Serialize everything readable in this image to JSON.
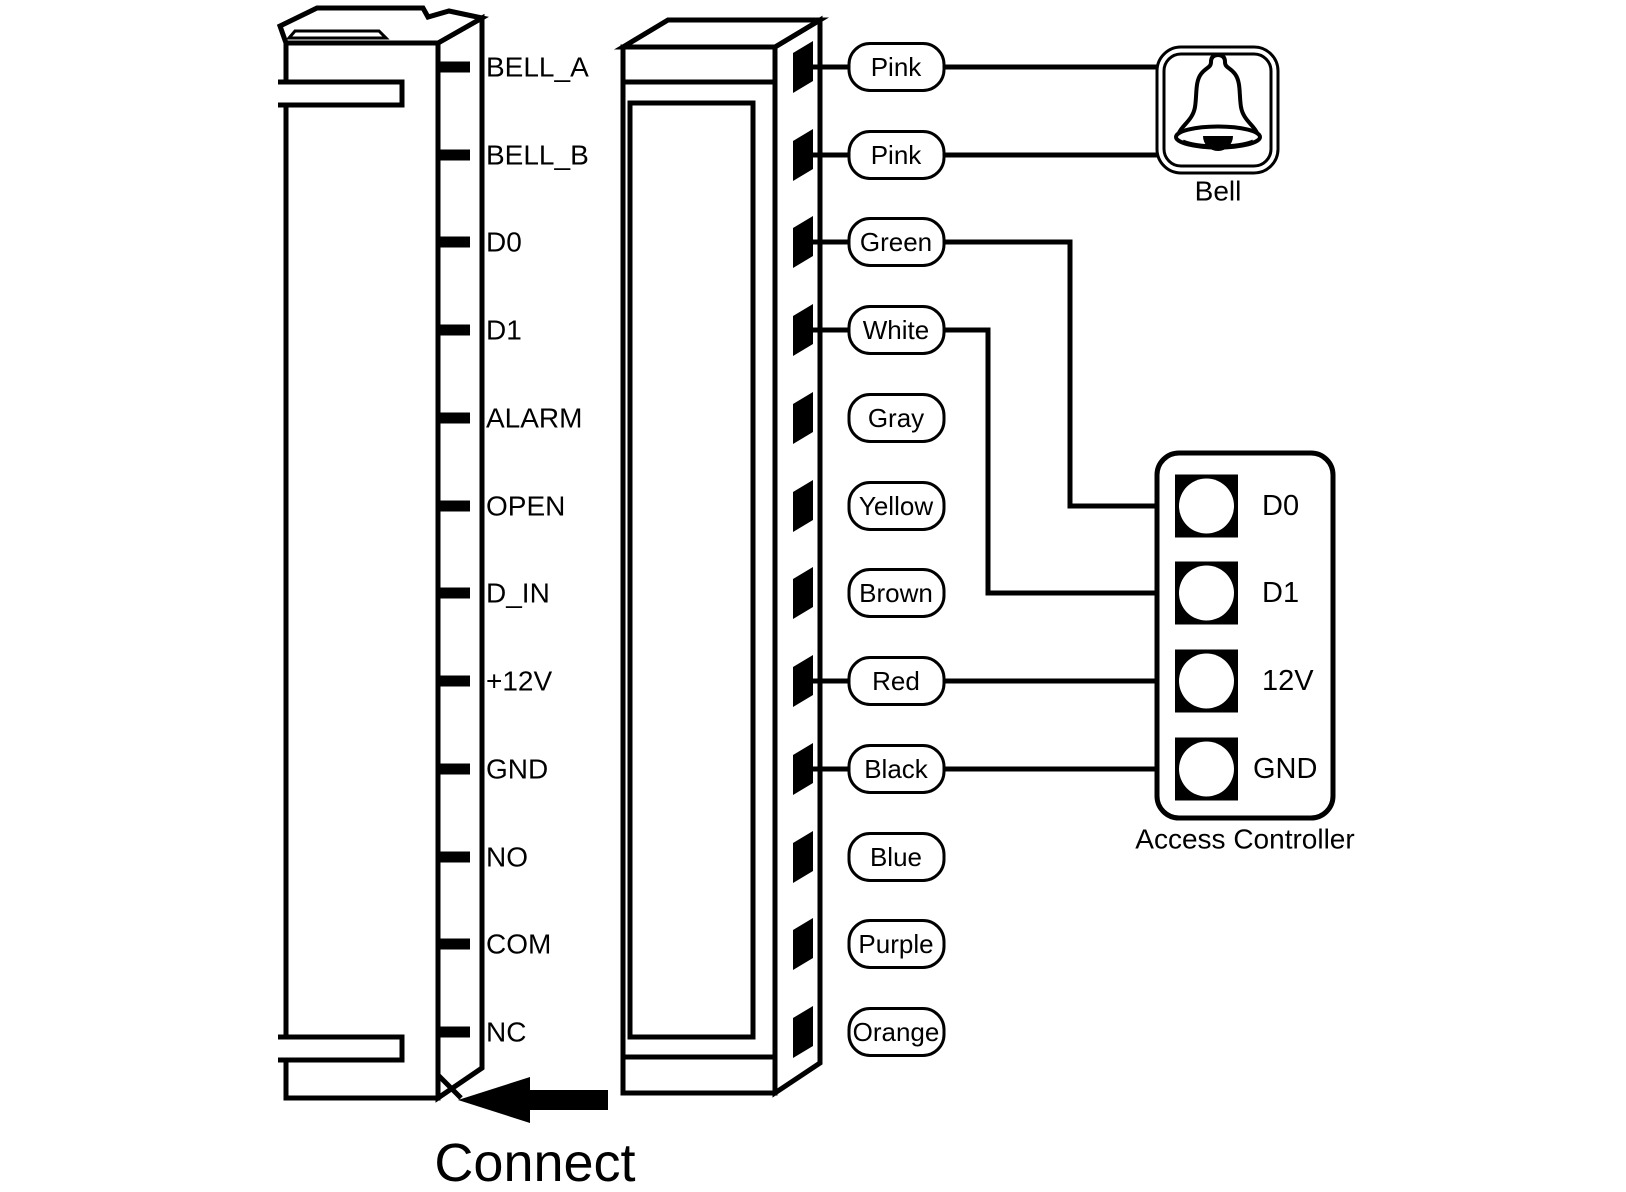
{
  "figure": {
    "background_color": "#ffffff",
    "line_color": "#000000",
    "connect_label": "Connect"
  },
  "left_connector": {
    "pins": [
      "BELL_A",
      "BELL_B",
      "D0",
      "D1",
      "ALARM",
      "OPEN",
      "D_IN",
      "+12V",
      "GND",
      "NO",
      "COM",
      "NC"
    ]
  },
  "wire_harness": {
    "labels": [
      "Pink",
      "Pink",
      "Green",
      "White",
      "Gray",
      "Yellow",
      "Brown",
      "Red",
      "Black",
      "Blue",
      "Purple",
      "Orange"
    ],
    "connections": [
      {
        "wire": "Pink",
        "to": "Bell"
      },
      {
        "wire": "Pink",
        "to": "Bell"
      },
      {
        "wire": "Green",
        "to": "D0"
      },
      {
        "wire": "White",
        "to": "D1"
      },
      {
        "wire": "Red",
        "to": "12V"
      },
      {
        "wire": "Black",
        "to": "GND"
      }
    ]
  },
  "bell": {
    "label": "Bell"
  },
  "access_controller": {
    "title": "Access Controller",
    "pins": [
      "D0",
      "D1",
      "12V",
      "GND"
    ]
  }
}
